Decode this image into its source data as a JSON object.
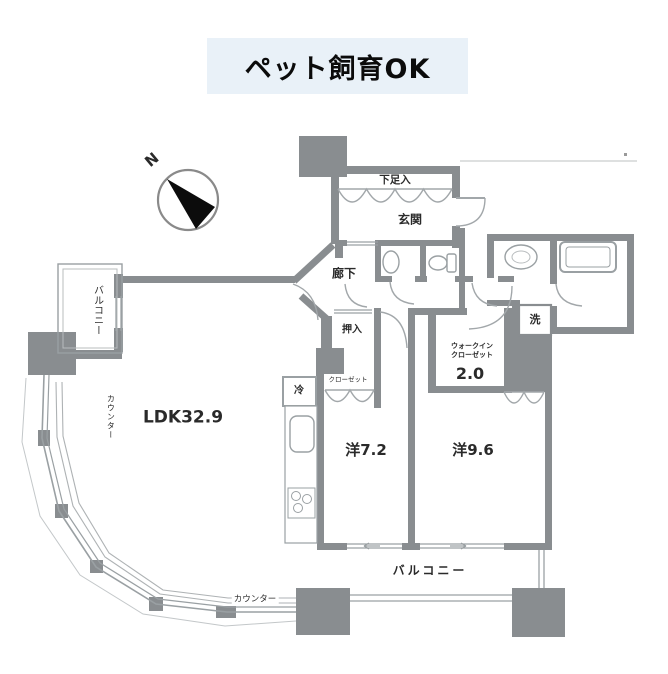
{
  "banner": {
    "text": "ペット飼育OK"
  },
  "compass": {
    "north_label": "N"
  },
  "rooms": {
    "shoe_cabinet": "下足入",
    "entrance": "玄関",
    "corridor": "廊下",
    "oshiire_closet": "押入",
    "closet": "クローゼット",
    "refrigerator": "冷",
    "laundry": "洗",
    "walk_in_line1": "ウォークイン",
    "walk_in_line2": "クローゼット",
    "walk_in_size": "2.0",
    "ldk": "LDK32.9",
    "western_room_1": "洋7.2",
    "western_room_2": "洋9.6",
    "balcony_left": "バルコニー",
    "balcony_bottom": "バルコニー",
    "counter_left": "カウンター",
    "counter_bottom": "カウンター"
  },
  "colors": {
    "wall_gray": "#898d90",
    "line_gray": "#9aa0a3",
    "banner_bg": "#e9f1f8",
    "text_ink": "#1f1f1f",
    "compass_black": "#0c0c0c"
  }
}
